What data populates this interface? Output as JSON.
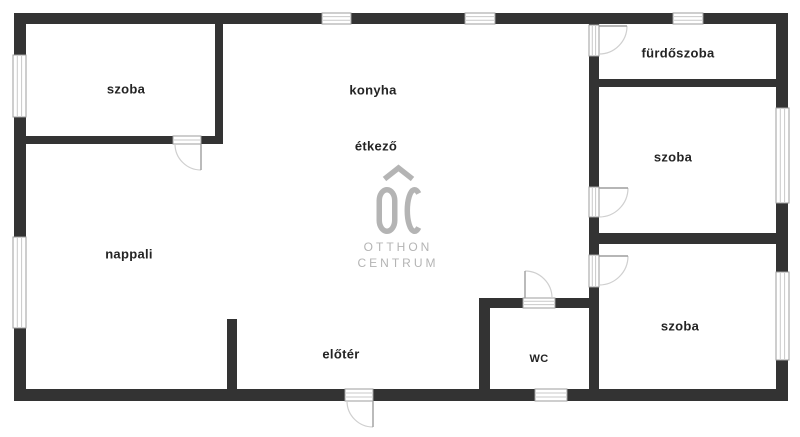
{
  "rooms": [
    {
      "id": "szoba-topleft",
      "label": "szoba"
    },
    {
      "id": "konyha",
      "label": "konyha"
    },
    {
      "id": "etkezo",
      "label": "étkező"
    },
    {
      "id": "furdoszoba",
      "label": "fürdőszoba"
    },
    {
      "id": "szoba-right",
      "label": "szoba"
    },
    {
      "id": "nappali",
      "label": "nappali"
    },
    {
      "id": "eloter",
      "label": "előtér"
    },
    {
      "id": "wc",
      "label": "wc"
    },
    {
      "id": "szoba-bottomright",
      "label": "szoba"
    }
  ],
  "logo": {
    "monogram": "OC",
    "line1": "OTTHON",
    "line2": "CENTRUM"
  },
  "colors": {
    "wall": "#333333",
    "window_frame": "#9e9e9e",
    "window_pane": "#c9c9c9",
    "door_arc": "#cfcfcf",
    "room_label": "#242424",
    "logo_gray": "#b4b4b4",
    "background": "#ffffff"
  }
}
